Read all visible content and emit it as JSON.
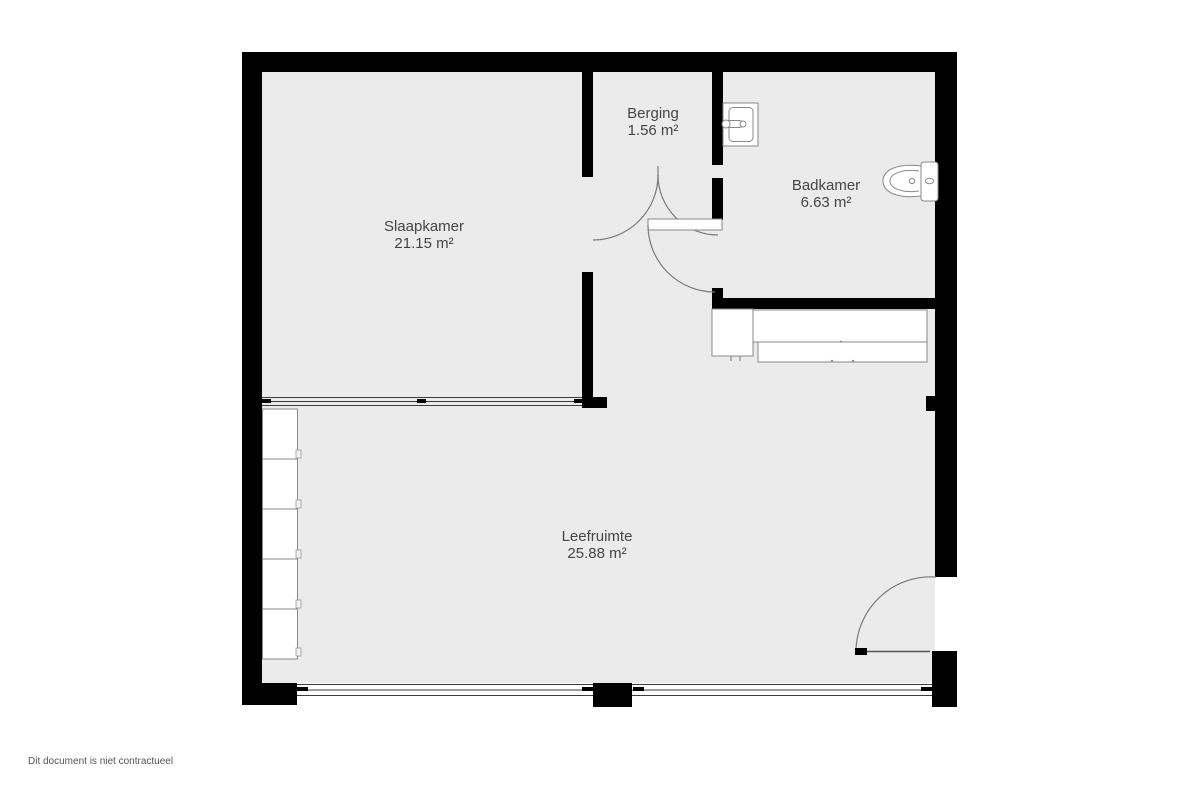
{
  "floorplan": {
    "rooms": [
      {
        "name": "Slaapkamer",
        "area": "21.15 m²"
      },
      {
        "name": "Berging",
        "area": "1.56 m²"
      },
      {
        "name": "Badkamer",
        "area": "6.63 m²"
      },
      {
        "name": "Leefruimte",
        "area": "25.88 m²"
      }
    ],
    "fixtures": [
      "sink-icon",
      "toilet-icon",
      "kitchen-counter",
      "closet-unit",
      "door-swing-arcs",
      "entrance-door",
      "windows",
      "glass-partition"
    ],
    "colors": {
      "wall": "#000000",
      "floor": "#ebebeb",
      "fixture_stroke": "#8a8a8a",
      "label_text": "#454545",
      "background": "#ffffff"
    }
  },
  "footer": {
    "disclaimer": "Dit document is niet contractueel"
  }
}
